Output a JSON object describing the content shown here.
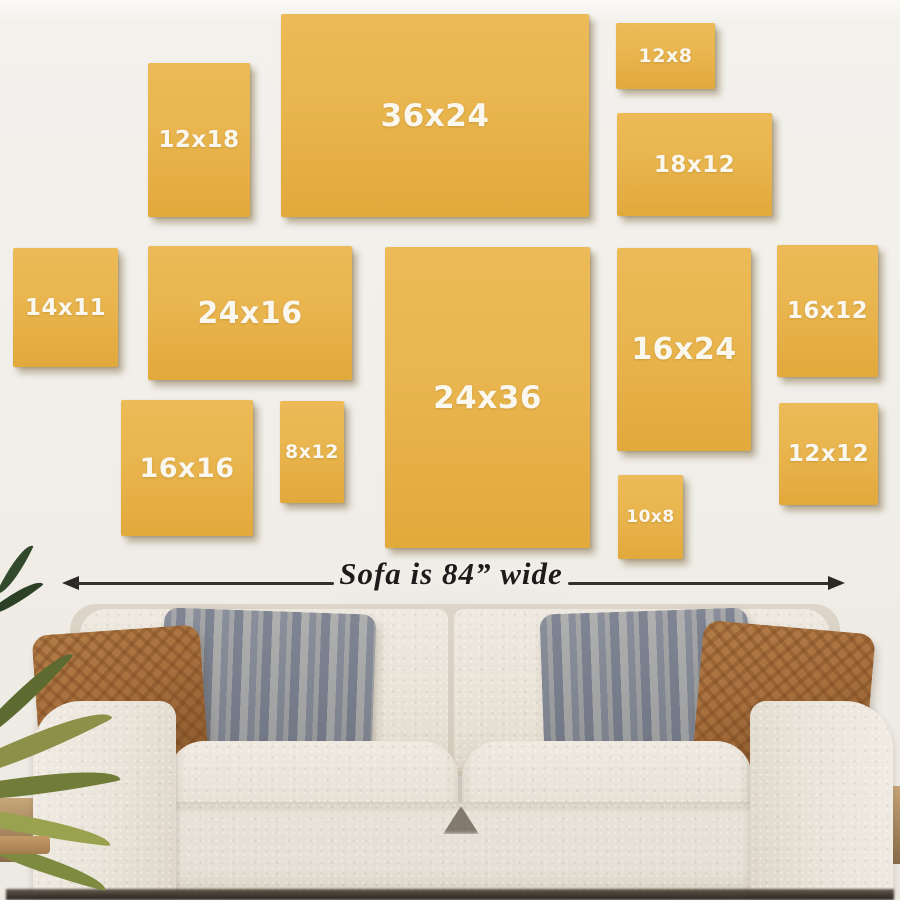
{
  "annotation": {
    "label": "Sofa is 84” wide"
  },
  "frames": [
    {
      "label": "12x18",
      "x": 148,
      "y": 63,
      "w": 102,
      "h": 154,
      "font": 23
    },
    {
      "label": "36x24",
      "x": 281,
      "y": 14,
      "w": 308,
      "h": 203,
      "font": 31
    },
    {
      "label": "12x8",
      "x": 616,
      "y": 23,
      "w": 99,
      "h": 66,
      "font": 19
    },
    {
      "label": "18x12",
      "x": 617,
      "y": 113,
      "w": 155,
      "h": 103,
      "font": 23
    },
    {
      "label": "14x11",
      "x": 13,
      "y": 248,
      "w": 105,
      "h": 119,
      "font": 23
    },
    {
      "label": "24x16",
      "x": 148,
      "y": 246,
      "w": 204,
      "h": 134,
      "font": 30
    },
    {
      "label": "24x36",
      "x": 385,
      "y": 247,
      "w": 205,
      "h": 301,
      "font": 31
    },
    {
      "label": "16x24",
      "x": 617,
      "y": 248,
      "w": 134,
      "h": 203,
      "font": 30
    },
    {
      "label": "16x12",
      "x": 777,
      "y": 245,
      "w": 101,
      "h": 132,
      "font": 23
    },
    {
      "label": "16x16",
      "x": 121,
      "y": 400,
      "w": 132,
      "h": 136,
      "font": 27
    },
    {
      "label": "8x12",
      "x": 280,
      "y": 401,
      "w": 64,
      "h": 102,
      "font": 19
    },
    {
      "label": "12x12",
      "x": 779,
      "y": 403,
      "w": 99,
      "h": 102,
      "font": 23
    },
    {
      "label": "10x8",
      "x": 618,
      "y": 475,
      "w": 65,
      "h": 84,
      "font": 17
    }
  ],
  "colors": {
    "frame_yellow": "#E9B54E",
    "frame_yellow_dark": "#E2A93C",
    "label_text": "#FAF7EF",
    "wall": "#F1EFEA",
    "annotation_text": "#1E1C1A",
    "sofa_cream": "#E9E4DA",
    "pillow_brown": "#A8703E",
    "pillow_gray": "#C3C6CD",
    "plant_green": "#7E8A40"
  }
}
